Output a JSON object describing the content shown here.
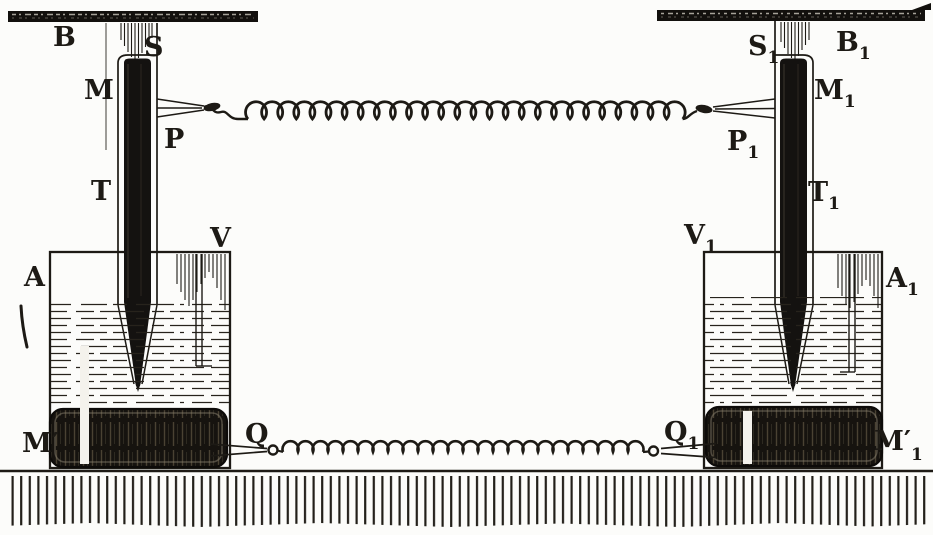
{
  "labels": {
    "B": {
      "base": "B",
      "sub": ""
    },
    "S": {
      "base": "S",
      "sub": ""
    },
    "M": {
      "base": "M",
      "sub": ""
    },
    "P": {
      "base": "P",
      "sub": ""
    },
    "T": {
      "base": "T",
      "sub": ""
    },
    "A": {
      "base": "A",
      "sub": ""
    },
    "V": {
      "base": "V",
      "sub": ""
    },
    "Mp": {
      "base": "M′",
      "sub": ""
    },
    "Q": {
      "base": "Q",
      "sub": ""
    },
    "S1": {
      "base": "S",
      "sub": "1"
    },
    "B1": {
      "base": "B",
      "sub": "1"
    },
    "M1": {
      "base": "M",
      "sub": "1"
    },
    "P1": {
      "base": "P",
      "sub": "1"
    },
    "T1": {
      "base": "T",
      "sub": "1"
    },
    "V1": {
      "base": "V",
      "sub": "1"
    },
    "A1": {
      "base": "A",
      "sub": "1"
    },
    "Q1": {
      "base": "Q",
      "sub": "1"
    },
    "Mp1": {
      "base": "M′",
      "sub": "1"
    }
  },
  "colors": {
    "ink": "#1d1a15",
    "paper": "#fcfcfa",
    "block_fill": "#16130f"
  }
}
